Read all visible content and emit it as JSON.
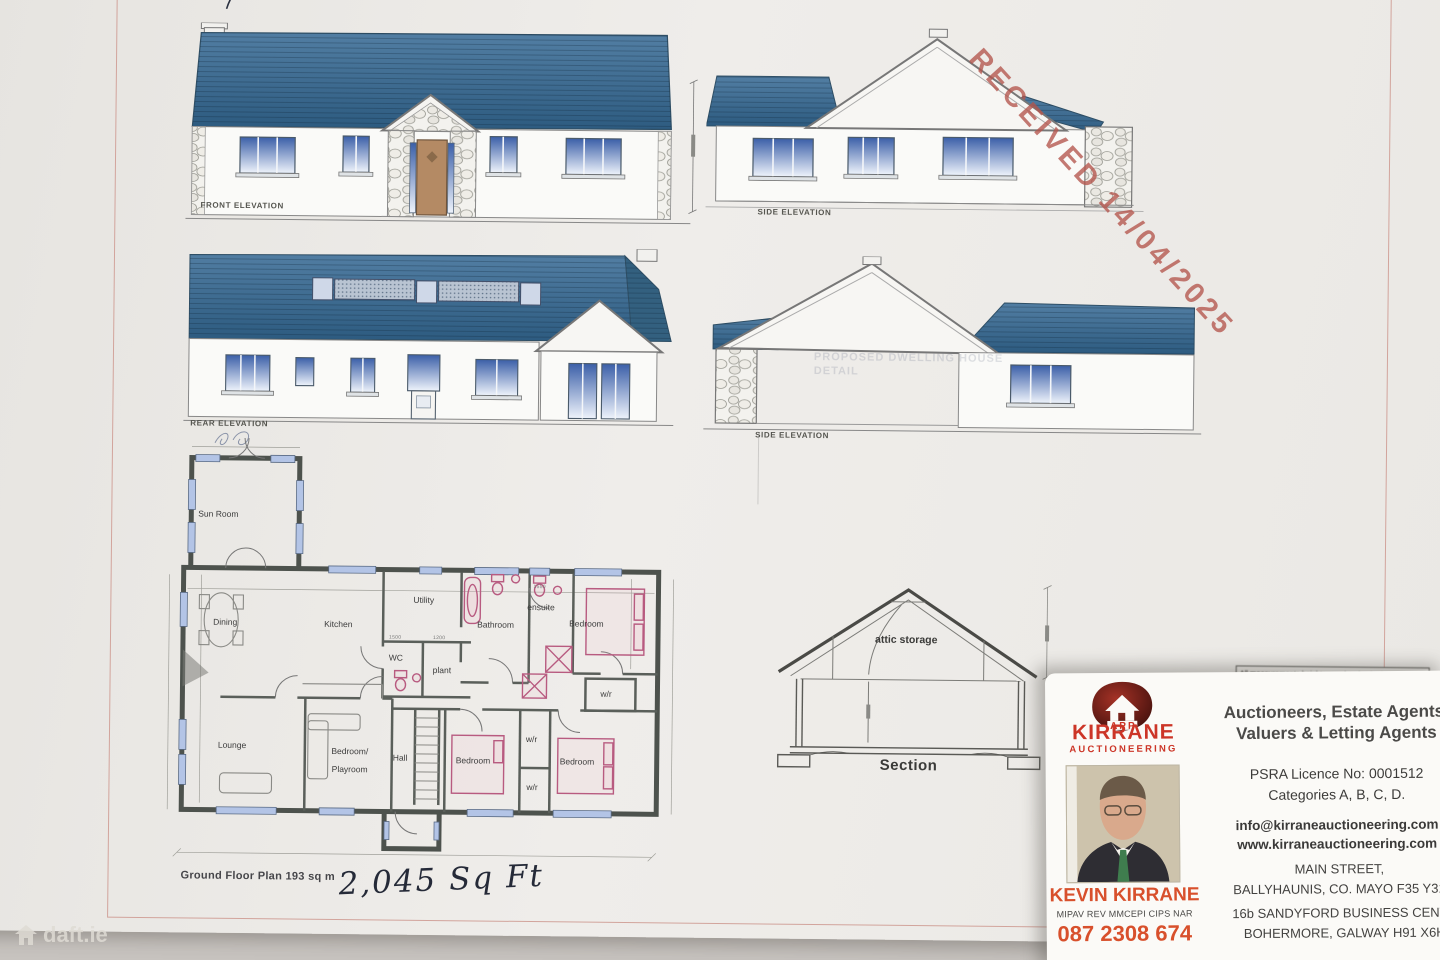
{
  "stamp": {
    "text": "RECEIVED 14/04/2025"
  },
  "watermark": {
    "text": "daft.ie"
  },
  "elevations": {
    "front": {
      "label": "FRONT ELEVATION"
    },
    "side1": {
      "label": "SIDE ELEVATION"
    },
    "rear": {
      "label": "REAR ELEVATION"
    },
    "side2": {
      "label": "SIDE ELEVATION"
    },
    "faint_title": "PROPOSED DWELLING HOUSE",
    "faint_sub": "DETAIL"
  },
  "section": {
    "attic_label": "attic storage",
    "caption": "Section"
  },
  "floor_plan": {
    "caption": "Ground Floor Plan  193 sq m",
    "handwritten": "2,045 Sq Ft",
    "rooms": {
      "sun_room": "Sun Room",
      "dining": "Dining",
      "kitchen": "Kitchen",
      "utility": "Utility",
      "wc": "WC",
      "plant": "plant",
      "bathroom": "Bathroom",
      "ensuite": "ensuite",
      "bedroom_top": "Bedroom",
      "wr_top": "w/r",
      "lounge": "Lounge",
      "playroom_line1": "Bedroom/",
      "playroom_line2": "Playroom",
      "hall": "Hall",
      "bedroom_mid": "Bedroom",
      "wr_closet1": "w/r",
      "wr_closet2": "w/r",
      "bedroom_right": "Bedroom"
    },
    "dims": {
      "d1": "1500",
      "d2": "1200",
      "d3": "1550"
    }
  },
  "note": {
    "text": "All measurements heights may be checked"
  },
  "card": {
    "logo": {
      "app": "APP",
      "name": "KIRRANE",
      "sub": "AUCTIONEERING"
    },
    "tagline_line1": "Auctioneers, Estate Agents,",
    "tagline_line2": "Valuers & Letting Agents",
    "psra": "PSRA Licence No: 0001512",
    "categories": "Categories A, B, C, D.",
    "email": "info@kirraneauctioneering.com",
    "web": "www.kirraneauctioneering.com",
    "addr1_line1": "MAIN STREET,",
    "addr1_line2": "BALLYHAUNIS, CO. MAYO F35 Y31",
    "addr2_line1": "16b SANDYFORD BUSINESS CENTR",
    "addr2_line2": "BOHERMORE, GALWAY H91 X6H",
    "person": {
      "name": "KEVIN KIRRANE",
      "quals": "MIPAV REV MMCEPI CIPS NAR",
      "phone": "087 2308 674"
    }
  }
}
